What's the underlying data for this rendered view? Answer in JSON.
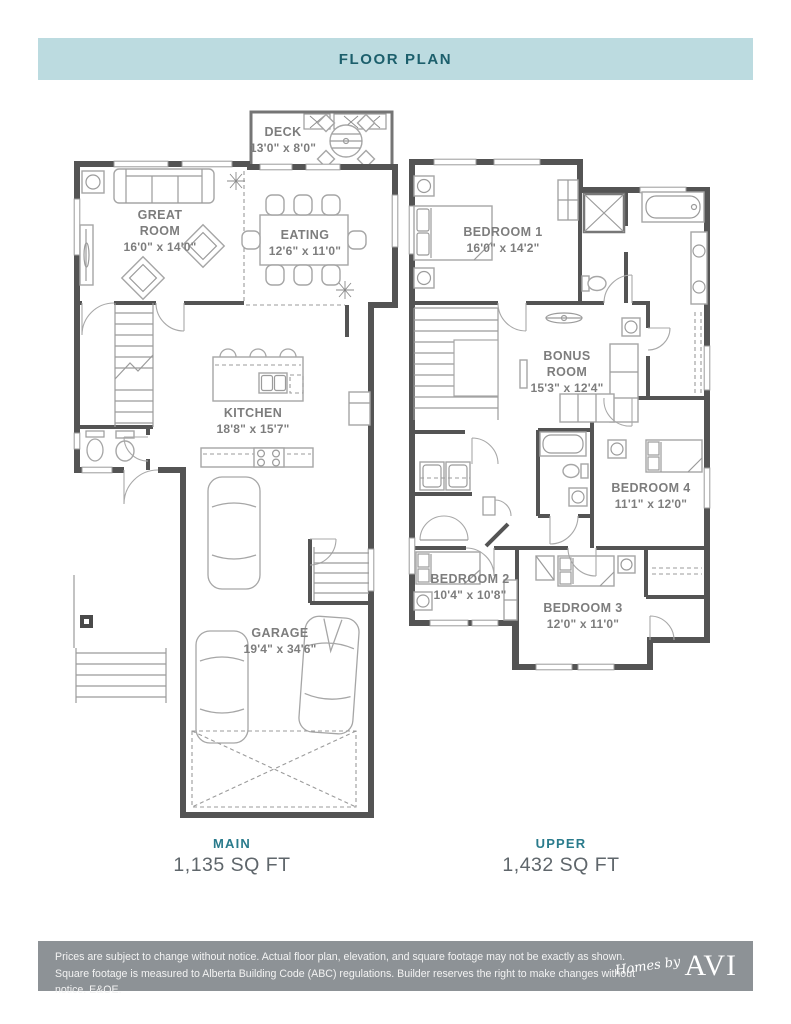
{
  "header": {
    "title": "FLOOR PLAN"
  },
  "plans": {
    "main": {
      "name": "MAIN",
      "area": "1,135 SQ FT",
      "rooms": {
        "deck": {
          "label": "DECK",
          "dims": "13'0\" x 8'0\""
        },
        "great_room": {
          "line1": "GREAT",
          "line2": "ROOM",
          "dims": "16'0\" x 14'0\""
        },
        "eating": {
          "label": "EATING",
          "dims": "12'6\" x 11'0\""
        },
        "kitchen": {
          "label": "KITCHEN",
          "dims": "18'8\" x 15'7\""
        },
        "garage": {
          "label": "GARAGE",
          "dims": "19'4\" x 34'6\""
        }
      }
    },
    "upper": {
      "name": "UPPER",
      "area": "1,432 SQ FT",
      "rooms": {
        "bedroom1": {
          "label": "BEDROOM 1",
          "dims": "16'0\" x 14'2\""
        },
        "bonus_room": {
          "line1": "BONUS",
          "line2": "ROOM",
          "dims": "15'3\" x 12'4\""
        },
        "bedroom4": {
          "label": "BEDROOM 4",
          "dims": "11'1\" x 12'0\""
        },
        "bedroom2": {
          "label": "BEDROOM 2",
          "dims": "10'4\" x 10'8\""
        },
        "bedroom3": {
          "label": "BEDROOM 3",
          "dims": "12'0\" x 11'0\""
        }
      }
    }
  },
  "footer": {
    "disclaimer": "Prices are subject to change without notice. Actual floor plan, elevation, and square footage may not be exactly as shown. Square footage is measured to Alberta Building Code (ABC) regulations. Builder reserves the right to make changes without notice. E&OE.",
    "logo_script": "Homes by",
    "logo_serif": "AVI"
  },
  "colors": {
    "banner_bg": "#bcdbe0",
    "accent_teal": "#1c5f6c",
    "caption_teal": "#2a7b8c",
    "area_gray": "#5f666b",
    "label_gray": "#7d7d7d",
    "wall_gray": "#545454",
    "furniture_gray": "#a6a6a6",
    "footer_bg": "#8d9296",
    "footer_text": "#f3f3f3"
  }
}
